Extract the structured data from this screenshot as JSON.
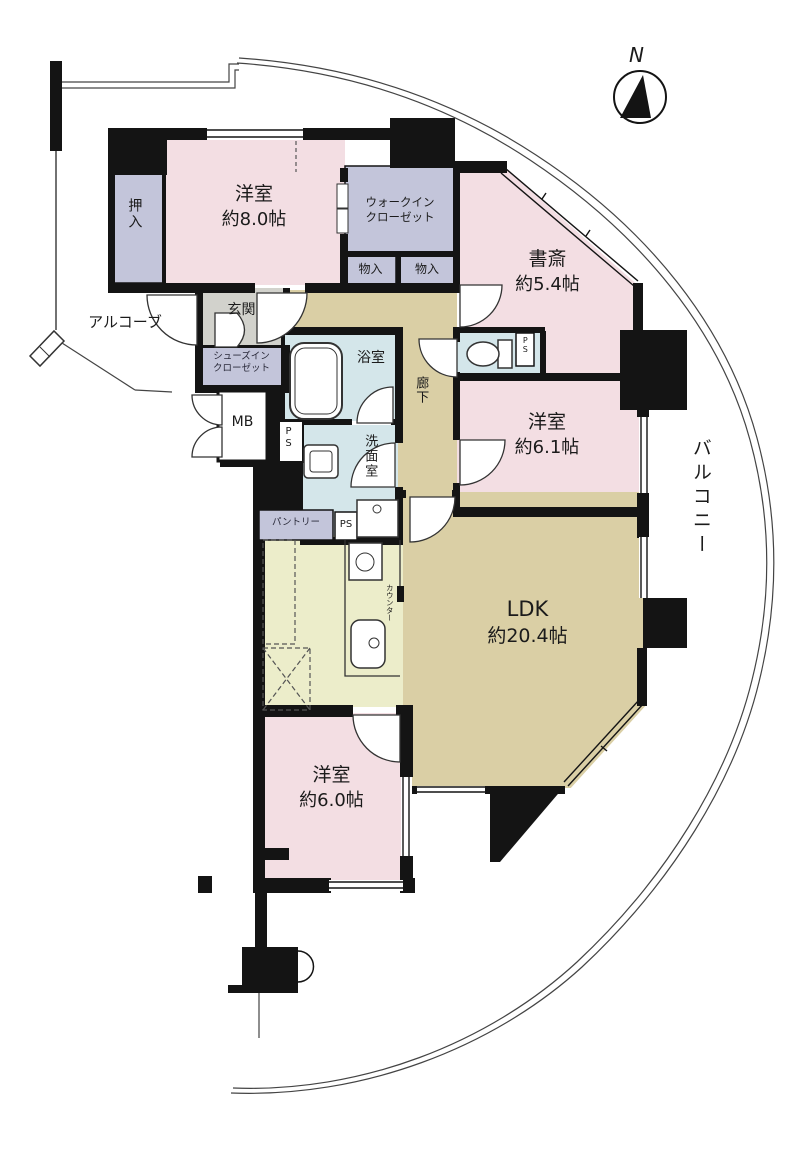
{
  "compass": {
    "north": "N"
  },
  "rooms": {
    "bedroom8": {
      "name": "洋室",
      "size": "約8.0帖"
    },
    "study": {
      "name": "書斎",
      "size": "約5.4帖"
    },
    "bedroom61": {
      "name": "洋室",
      "size": "約6.1帖"
    },
    "ldk": {
      "name": "LDK",
      "size": "約20.4帖"
    },
    "bedroom6": {
      "name": "洋室",
      "size": "約6.0帖"
    }
  },
  "spaces": {
    "oshiire": "押入",
    "wic_line1": "ウォークイン",
    "wic_line2": "クローゼット",
    "monoire": "物入",
    "genkan": "玄関",
    "sic_line1": "シューズイン",
    "sic_line2": "クローゼット",
    "mb": "MB",
    "ps": "PS",
    "bathroom": "浴室",
    "washroom": "洗面室",
    "corridor": "廊下",
    "pantry": "パントリー",
    "counter": "カウンター",
    "balcony": "バルコニー",
    "alcove": "アルコーブ"
  },
  "colors": {
    "wall": "#141414",
    "bedroom_pink": "#f3dee3",
    "closet_lavender": "#c3c5da",
    "ldk_tan": "#dacfa5",
    "kitchen_yellow": "#ecedca",
    "wet_blue": "#d4e6ea",
    "genkan_gray": "#d2d2cc"
  }
}
